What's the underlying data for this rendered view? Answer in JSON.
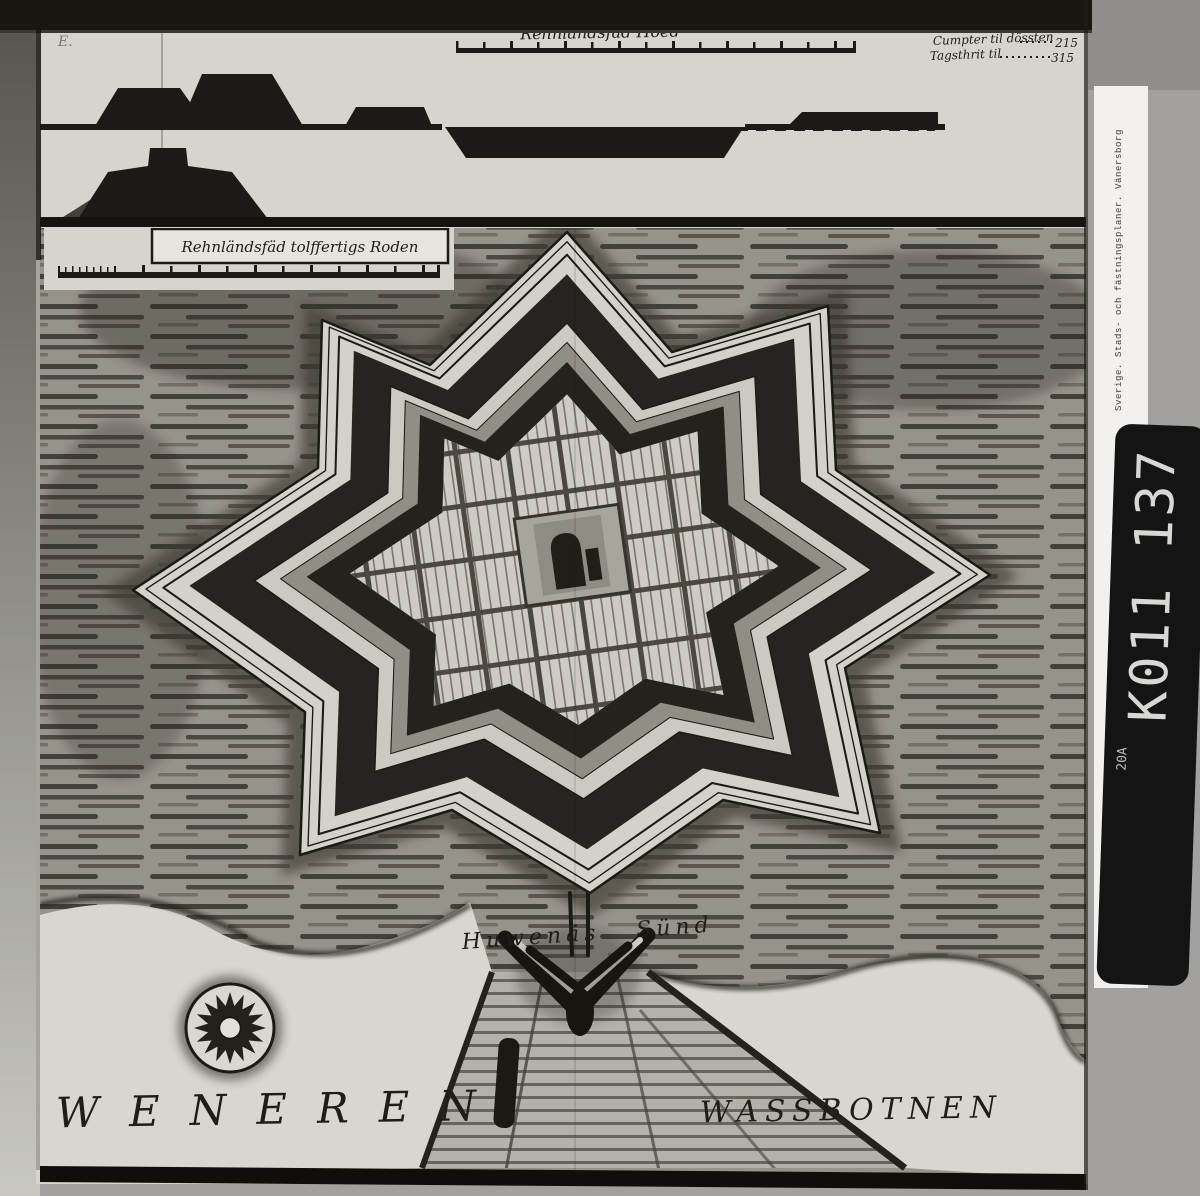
{
  "map": {
    "top_title": "Rehnländsfäd Hoed",
    "cartouche_title": "Rehnländsfäd tolffertigs Roden",
    "corner_mark": "E.",
    "legend": {
      "items": [
        {
          "label": "Cumpter til lüssten",
          "value": "150"
        },
        {
          "label": "Cumpter til dössten",
          "value": "215"
        },
        {
          "label": "Tagsthrit til",
          "value": "315"
        }
      ]
    },
    "labels": {
      "sound": "Huwenäs Sünd",
      "lake_left": "WENEREN",
      "lake_right": "WASSBOTNEN"
    }
  },
  "archive": {
    "side_label": "Sverige. Stads- och fästningsplaner. Vänersborg",
    "film_code": "K011 137",
    "film_code_sub": "20A"
  },
  "icons": {
    "compass_rose": "compass-rose-icon"
  },
  "colors": {
    "ink": "#1c1a16",
    "paper": "#d6d4cd",
    "water_base": "#96938b",
    "backing_white": "#f2f1ed",
    "tab_black": "#141414"
  }
}
